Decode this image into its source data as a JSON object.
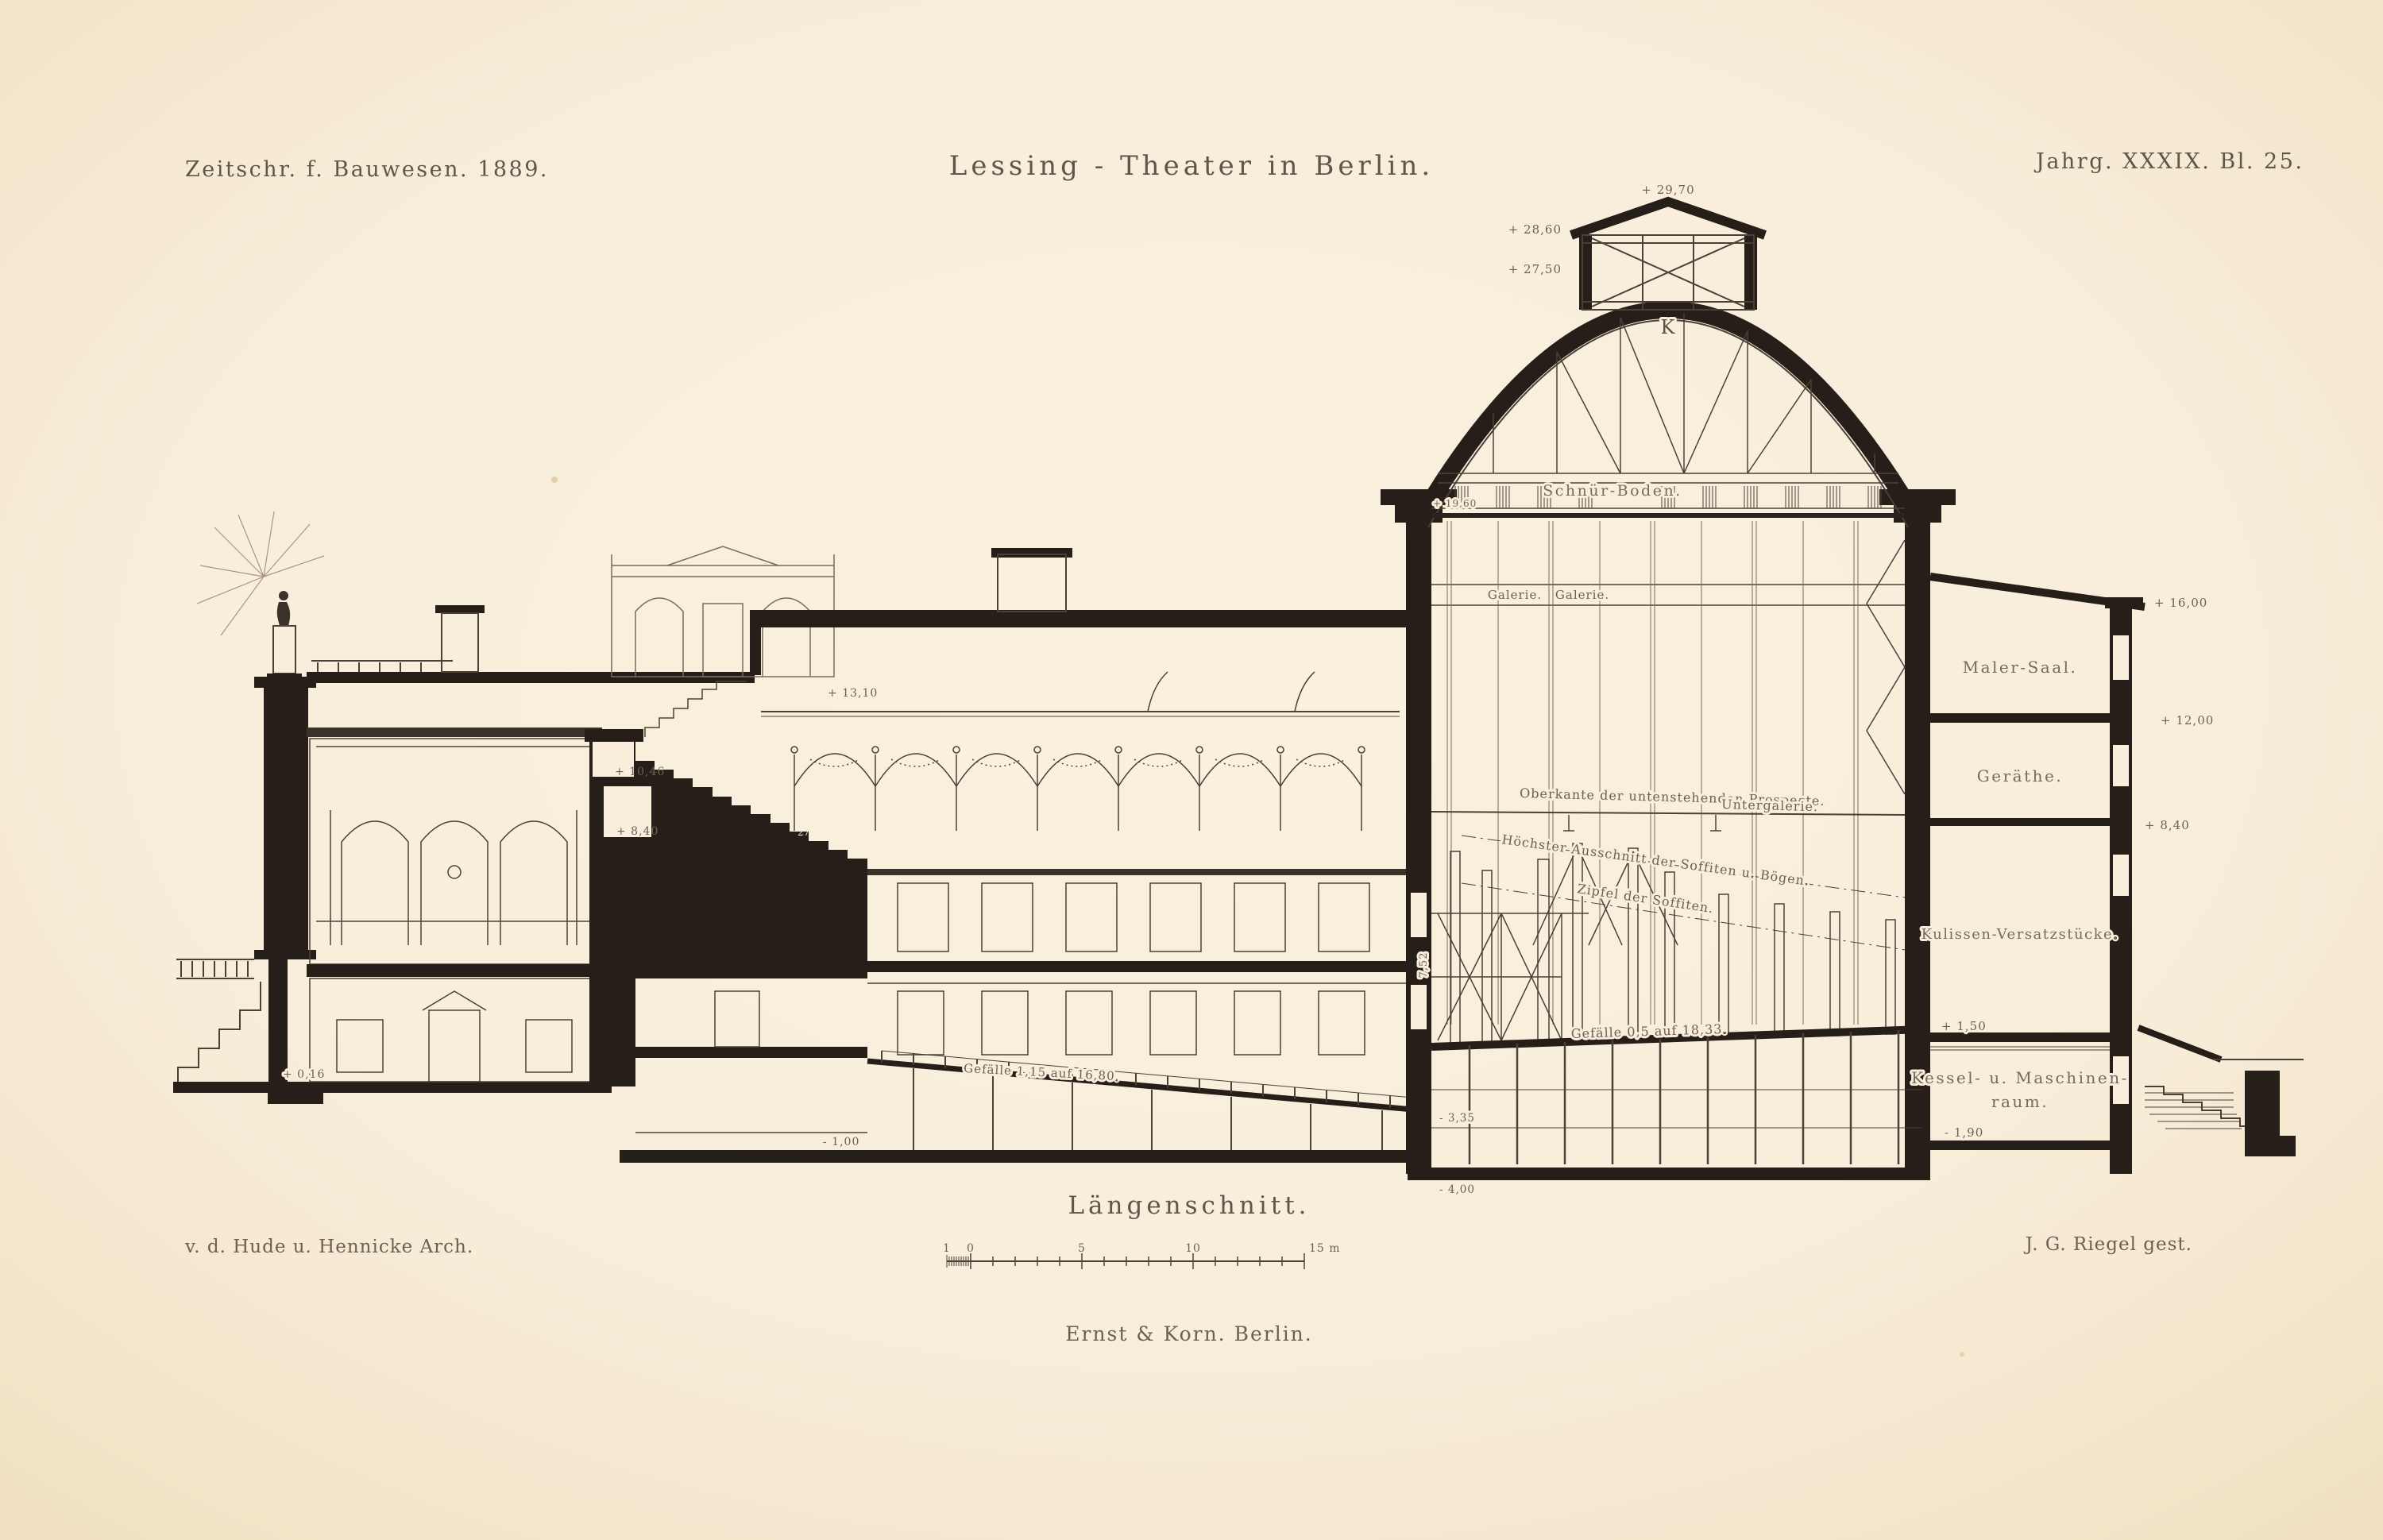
{
  "header": {
    "journal": "Zeitschr. f. Bauwesen. 1889.",
    "title": "Lessing - Theater in Berlin.",
    "plate": "Jahrg. XXXIX. Bl. 25."
  },
  "footer": {
    "caption": "Längenschnitt.",
    "architects": "v. d. Hude u. Hennicke Arch.",
    "engraver": "J. G. Riegel gest.",
    "publisher": "Ernst & Korn. Berlin."
  },
  "scale_bar": {
    "labels": [
      "1",
      "0",
      "5",
      "10",
      "15 m"
    ]
  },
  "stage_house": {
    "apex_level": "+ 29,70",
    "eaves_level": "+ 28,60",
    "lantern_base_level": "+ 27,50",
    "truss_mark": "K",
    "grid_floor": "Schnür-Boden.",
    "grid_floor_level": "+ 19,60",
    "gallery_left": "Galerie.",
    "gallery_right": "Galerie.",
    "note_prospecte": "Oberkante der untenstehenden Prospecte.",
    "note_untergalerie": "Untergalerie.",
    "note_soffiten": "Höchster Ausschnitt der Soffiten u. Bögen.",
    "note_zipfel": "Zipfel der Soffiten.",
    "stage_slope": "Gefälle 0,5 auf 18,33.",
    "dim_height": "7,52",
    "cellar_level": "- 3,35",
    "pit_level": "- 4,00"
  },
  "annex": {
    "painter_hall": "Maler-Saal.",
    "painter_hall_level": "+ 16,00",
    "equipment_room": "Geräthe.",
    "equipment_level": "+ 12,00",
    "equipment_floor_level": "+ 8,40",
    "scenery_store": "Kulissen-Versatzstücke.",
    "scenery_floor_level": "+ 1,50",
    "boiler_room_line1": "Kessel- u. Maschinen-",
    "boiler_room_line2": "raum.",
    "boiler_floor_level": "- 1,90"
  },
  "auditorium": {
    "ceiling_level": "+ 13,10",
    "balcony_level_upper": "+ 10,46",
    "balcony_level_lower": "+ 8,40",
    "step_number": "27",
    "parquet_slope": "Gefälle 1,15 auf 16,80.",
    "basement_level": "- 1,00",
    "ground_level": "+ 0,16"
  },
  "colors": {
    "paper": "#f8eedb",
    "paper_edge": "#f1e1c4",
    "ink": "#261f19",
    "annotation": "#6e6051"
  }
}
